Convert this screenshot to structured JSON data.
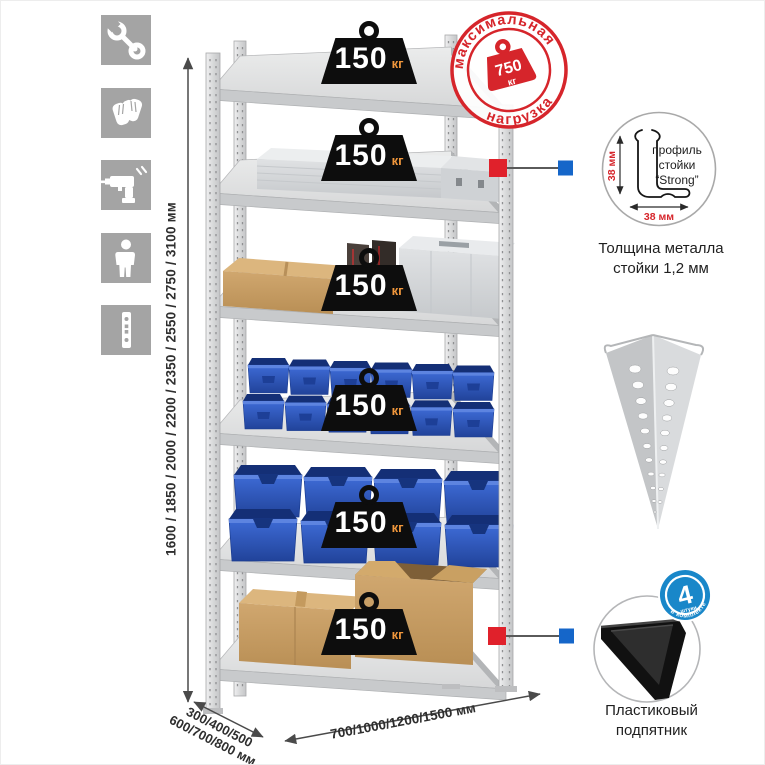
{
  "canvas": {
    "width": 765,
    "height": 765,
    "background": "#ffffff"
  },
  "icons": [
    {
      "name": "wrench-icon"
    },
    {
      "name": "gloves-icon"
    },
    {
      "name": "drill-icon"
    },
    {
      "name": "person-icon"
    },
    {
      "name": "rack-post-icon"
    }
  ],
  "max_load_stamp": {
    "arc_top": "максимальная",
    "arc_bottom": "нагрузка",
    "value": "750",
    "unit": "кг"
  },
  "shelf_loads": [
    {
      "value": "150",
      "unit": "кг"
    },
    {
      "value": "150",
      "unit": "кг"
    },
    {
      "value": "150",
      "unit": "кг"
    },
    {
      "value": "150",
      "unit": "кг"
    },
    {
      "value": "150",
      "unit": "кг"
    },
    {
      "value": "150",
      "unit": "кг"
    }
  ],
  "dimensions": {
    "height_label": "1600 / 1850 / 2000 / 2200 / 2350 / 2550 / 2750 / 3100 мм",
    "depth_label_line1": "300/400/500",
    "depth_label_line2": "600/700/800 мм",
    "width_label": "700/1000/1200/1500 мм"
  },
  "profile_detail": {
    "label_line1": "профиль",
    "label_line2": "стойки",
    "label_line3": "“Strong”",
    "dim_vertical": "38 мм",
    "dim_horizontal": "38 мм",
    "caption_line1": "Толщина металла",
    "caption_line2": "стойки 1,2 мм"
  },
  "foot_detail": {
    "badge_number": "4",
    "badge_note": "штуки",
    "badge_arc": "в комплекте",
    "caption_line1": "Пластиковый",
    "caption_line2": "подпятник"
  },
  "colors": {
    "stamp_red": "#d6252b",
    "callout_red": "#e0212b",
    "callout_blue": "#1566c9",
    "badge_blue": "#1987c9",
    "bin_blue": "#2b5ac6",
    "kraft": "#c59a63",
    "metal_light": "#dcdddf",
    "weight_black": "#0d0d0d",
    "weight_unit_orange": "#f0973c"
  }
}
